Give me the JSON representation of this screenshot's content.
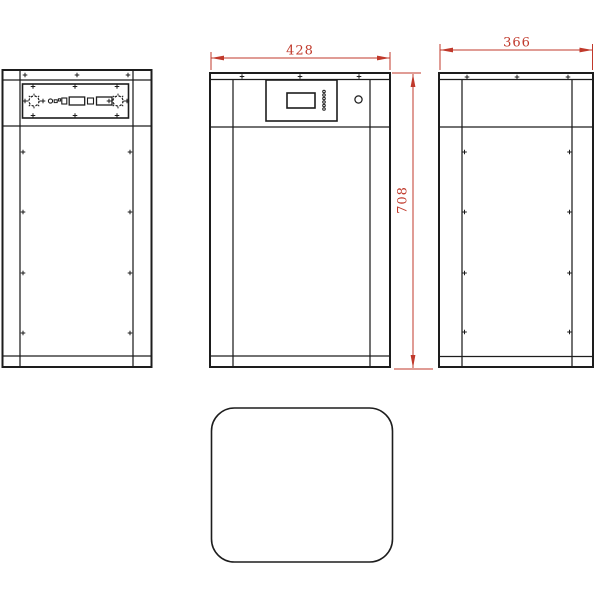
{
  "drawing": {
    "type": "three-view-engineering-drawing",
    "colors": {
      "line": "#1d1d1d",
      "dimension": "#c0392b",
      "background": "#ffffff"
    },
    "dimensions": {
      "front_width": "428",
      "side_depth": "366",
      "height": "708"
    }
  }
}
